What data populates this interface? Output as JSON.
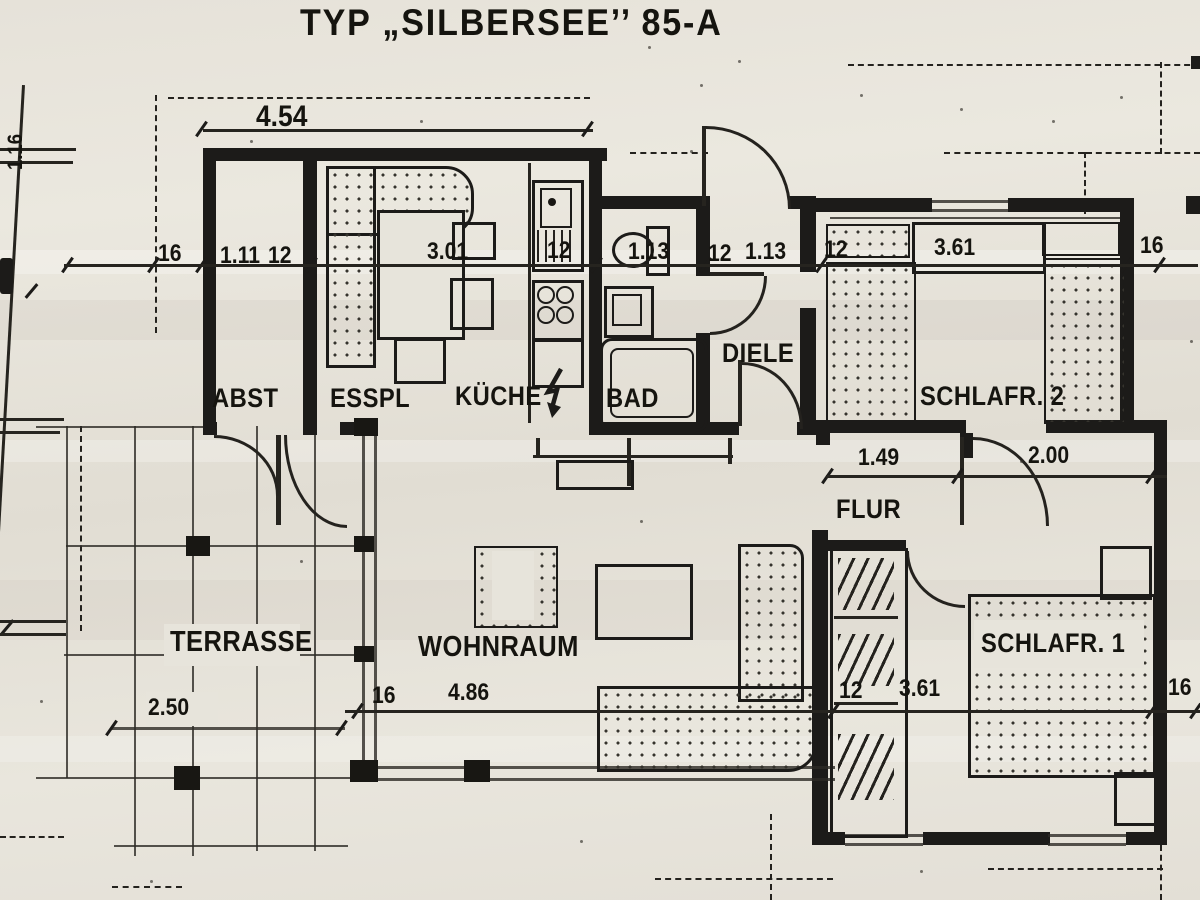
{
  "title": "TYP „SILBERSEE’’ 85-A",
  "rooms": {
    "abst": "ABST",
    "esspl": "ESSPL",
    "kueche": "KÜCHE",
    "bad": "BAD",
    "diele": "DIELE",
    "schlafr2": "SCHLAFR. 2",
    "flur": "FLUR",
    "schlafr1": "SCHLAFR. 1",
    "wohnraum": "WOHNRAUM",
    "terrasse": "TERRASSE"
  },
  "dims": {
    "overall_top": "4.54",
    "upper": [
      "16",
      "1.11",
      "12",
      "3.01",
      "12",
      "1.13",
      "12",
      "1.13",
      "12",
      "3.61",
      "16"
    ],
    "middle": [
      "1.49",
      "2.00"
    ],
    "lower": [
      "16",
      "4.86",
      "12",
      "3.61",
      "16"
    ],
    "terrace": "2.50",
    "left_edge": "1.16"
  },
  "symbols": {
    "kitchen_electric": "lightning-arrow"
  },
  "colors": {
    "paper": "#e4e1d8",
    "ink": "#1c1b19"
  }
}
